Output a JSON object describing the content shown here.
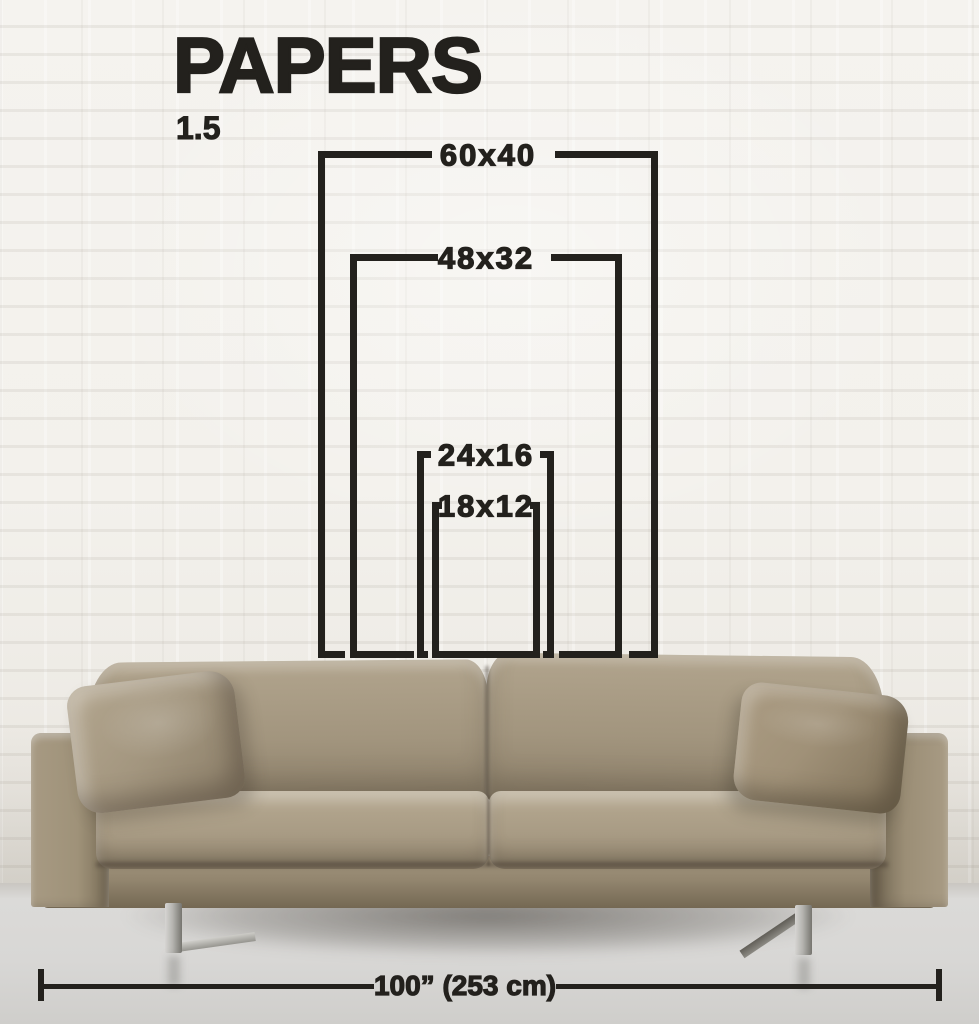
{
  "header": {
    "title": "PAPERS",
    "ratio": "1.5"
  },
  "diagram": {
    "sizes": [
      {
        "label": "60x40"
      },
      {
        "label": "48x32"
      },
      {
        "label": "24x16"
      },
      {
        "label": "18x12"
      }
    ]
  },
  "measurement": {
    "label": "100” (253 cm)"
  },
  "colors": {
    "ink": "#23211d"
  }
}
